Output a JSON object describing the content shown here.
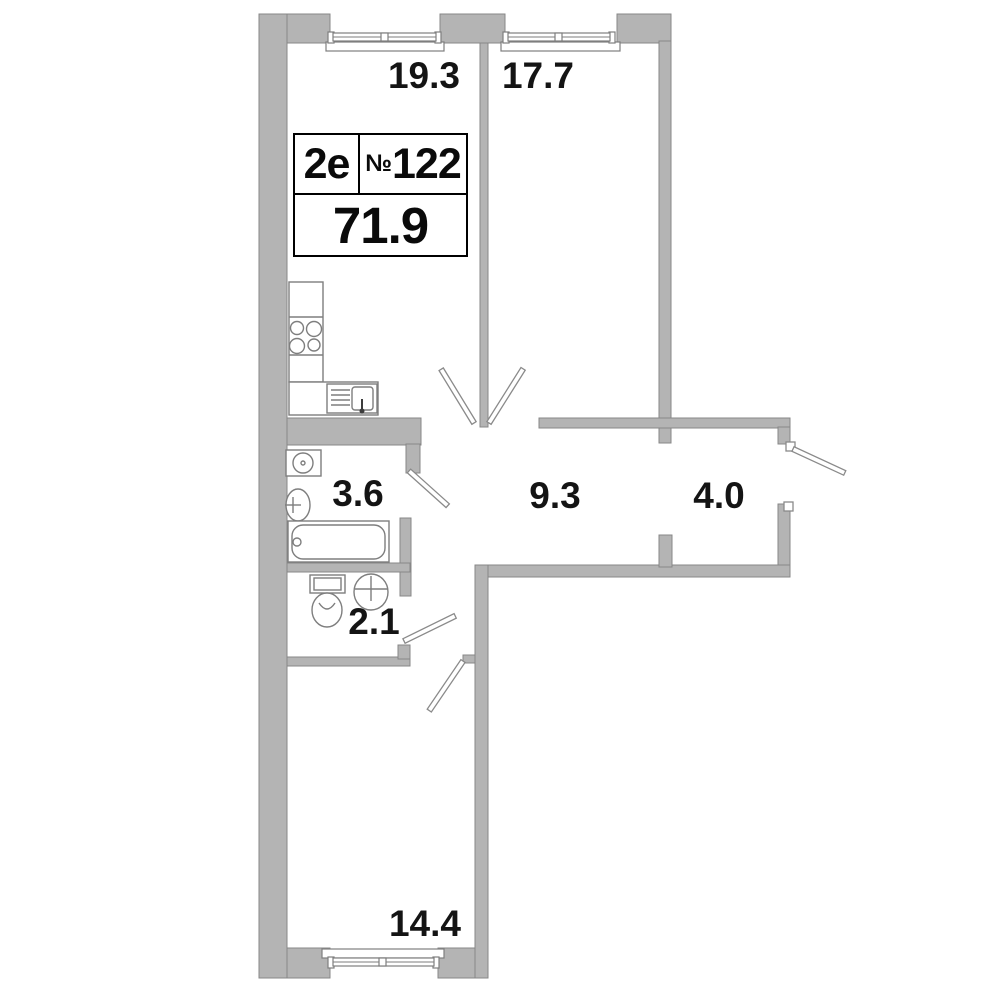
{
  "unit_card": {
    "plan_type": "2e",
    "number_sign": "№",
    "apartment_number": "122",
    "total_area": "71.9"
  },
  "rooms": [
    {
      "name": "kitchen-living-room",
      "area": "19.3"
    },
    {
      "name": "room-upper-right",
      "area": "17.7"
    },
    {
      "name": "bathroom",
      "area": "3.6"
    },
    {
      "name": "corridor",
      "area": "9.3"
    },
    {
      "name": "hallway",
      "area": "4.0"
    },
    {
      "name": "wc",
      "area": "2.1"
    },
    {
      "name": "room-bottom",
      "area": "14.4"
    }
  ],
  "icons": {
    "stove-icon": "four-burner-circles",
    "kitchen-counter-icon": "segmented-rectangle",
    "kitchen-sink-icon": "basin-with-drainboard-and-faucet",
    "washing-machine-icon": "square-with-round-door",
    "bath-sink-icon": "oval-basin-with-faucet-cross",
    "bathtub-icon": "rounded-rectangle-with-drain",
    "toilet-icon": "cistern-and-bowl",
    "wc-sink-icon": "oval-basin-with-faucet-cross",
    "window-icon": "double-line-glazing-with-sill",
    "door-icon": "angled-leaf-bar"
  },
  "colors": {
    "background": "#ffffff",
    "wall_fill": "#b4b4b4",
    "wall_outline": "#878787",
    "fixture_outline": "#7e7e7e",
    "label_text": "#141414",
    "card_border": "#000000"
  }
}
